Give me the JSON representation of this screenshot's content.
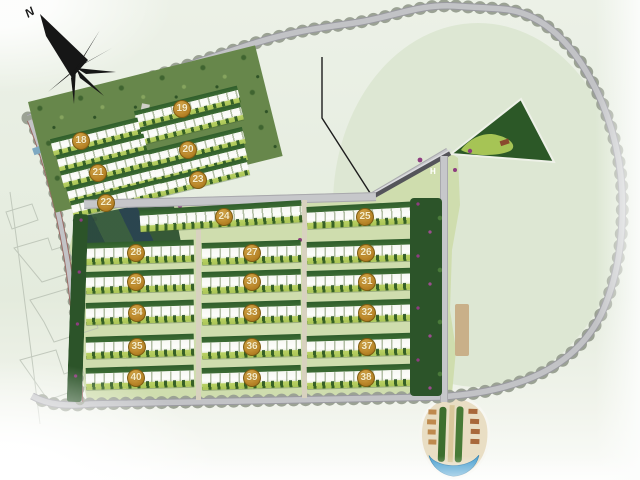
{
  "plan": {
    "compass_label": "N",
    "entrance_label": "H",
    "building_numbers": [
      "18",
      "19",
      "20",
      "21",
      "22",
      "23",
      "24",
      "25",
      "26",
      "27",
      "28",
      "29",
      "30",
      "31",
      "32",
      "33",
      "34",
      "35",
      "36",
      "37",
      "38",
      "39",
      "40"
    ]
  },
  "colors": {
    "badge_gold": "#B58226",
    "road_gray": "#BCBDC0",
    "tree_green": "#2E5C2A",
    "lawn_green": "#B6CF62",
    "flower_magenta": "#8D3D7F",
    "pool_blue": "#4AA0D0",
    "park_green": "#2D5A28",
    "background": "#E7EEE2"
  }
}
